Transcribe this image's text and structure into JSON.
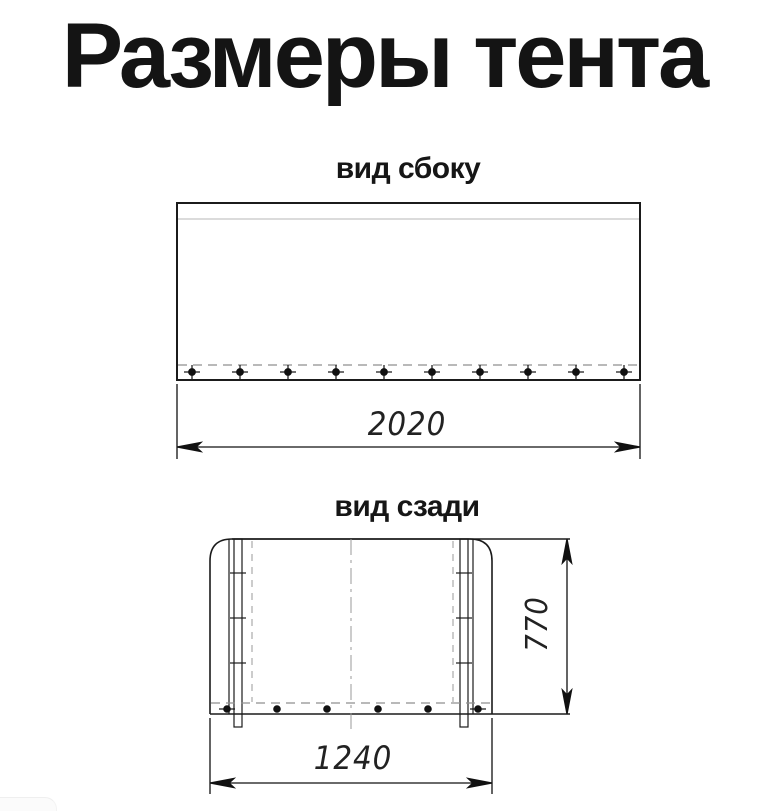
{
  "page": {
    "title": "Размеры тента",
    "background": "#ffffff"
  },
  "side_view": {
    "title": "вид сбоку",
    "width_label": "2020"
  },
  "rear_view": {
    "title": "вид сзади",
    "width_label": "1240",
    "height_label": "770"
  },
  "colors": {
    "line": "#1b1b1b",
    "seam": "#cfcfcf",
    "dashed": "#8f8f8f",
    "centerline": "#999999",
    "text": "#141414"
  }
}
